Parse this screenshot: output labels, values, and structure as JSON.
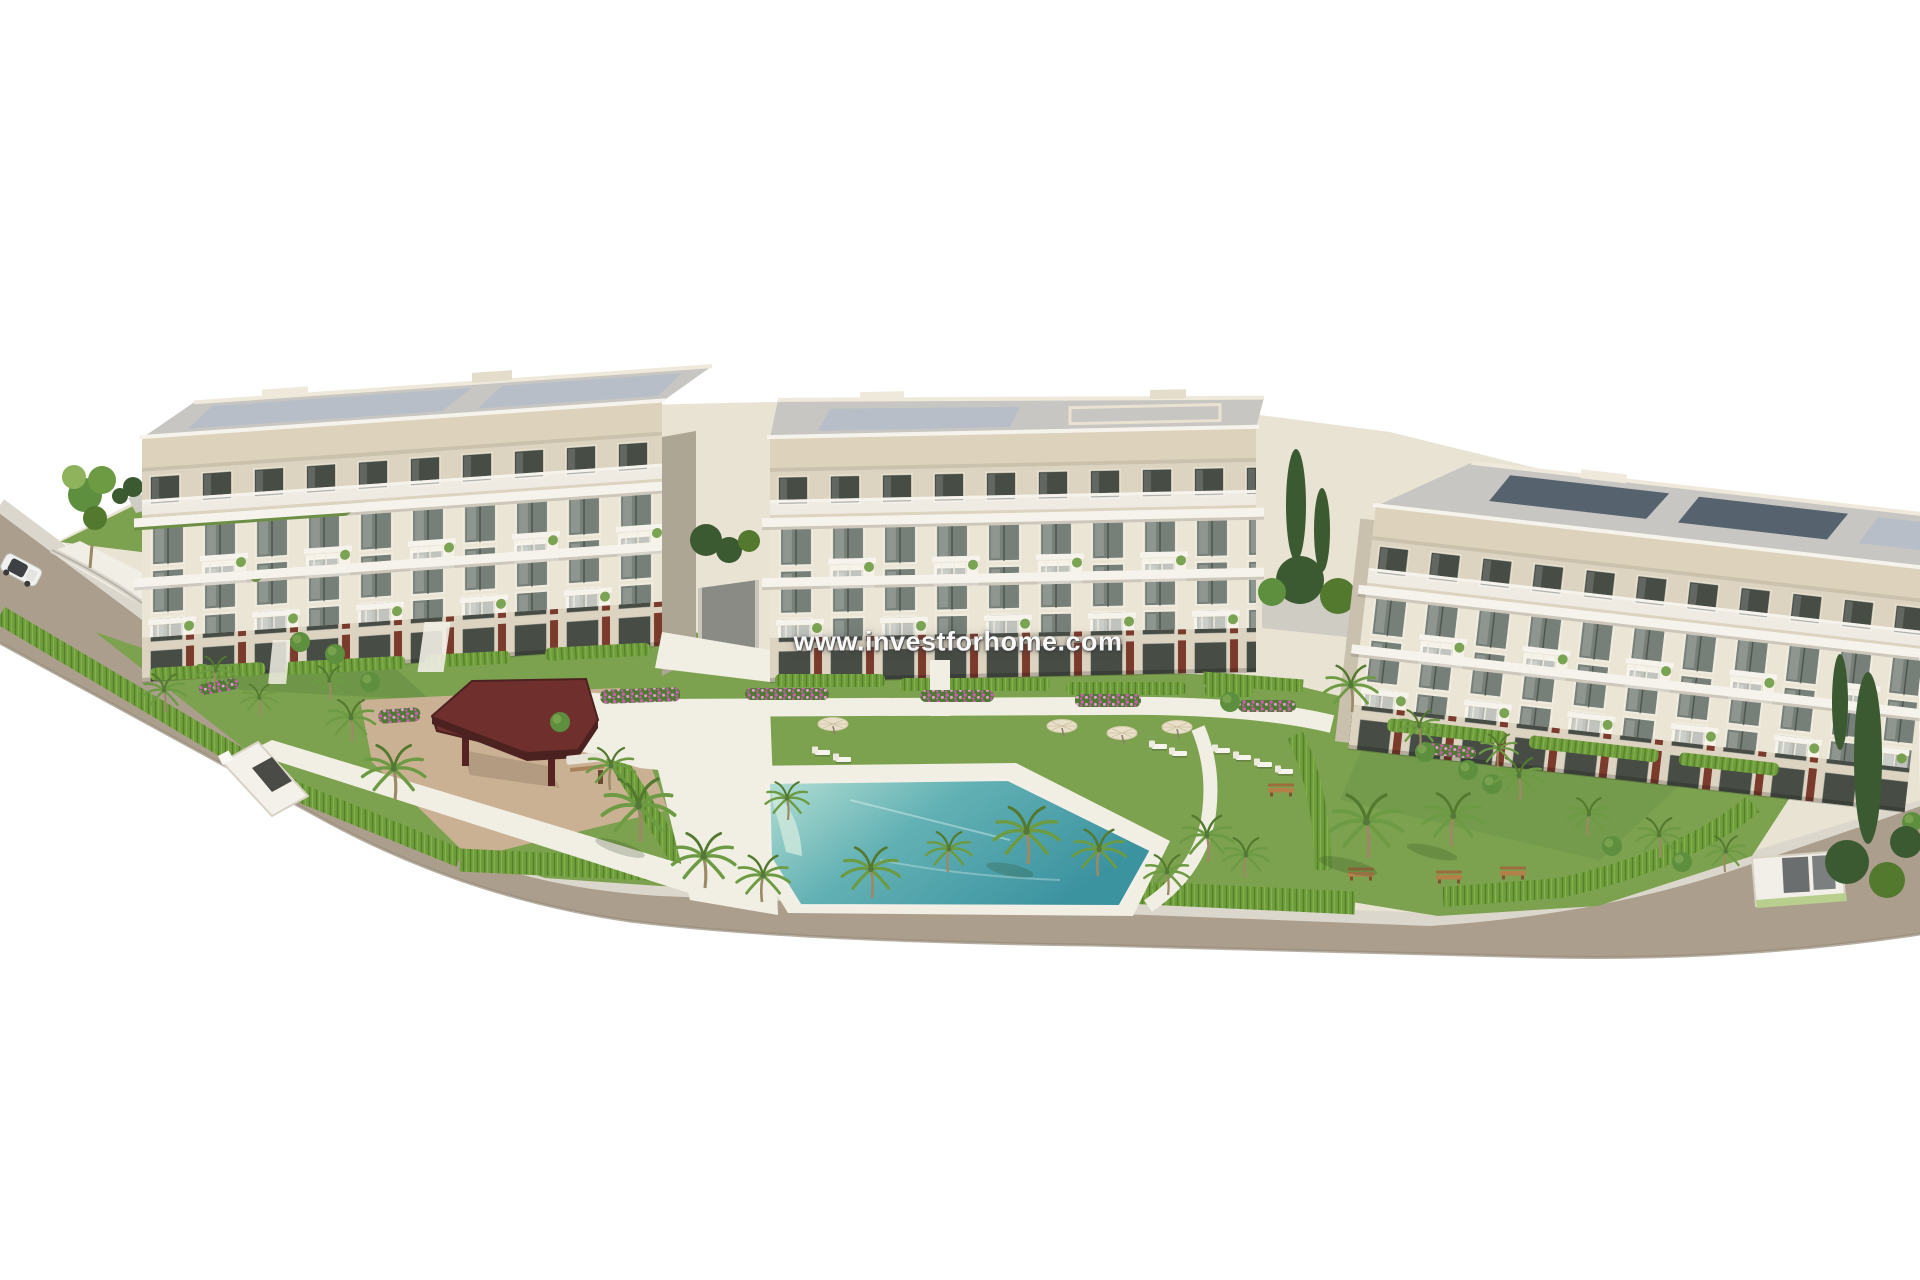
{
  "watermark": {
    "text": "www.investforhome.com"
  },
  "scene": {
    "type": "3D architectural rendering",
    "subject": "Residential apartment complex of three low-rise blocks with landscaped communal gardens",
    "buildings": [
      {
        "label": "left apartment block",
        "floors": 4
      },
      {
        "label": "middle apartment block",
        "floors": 4
      },
      {
        "label": "right apartment block",
        "floors": 4
      }
    ],
    "features": [
      "communal swimming pool",
      "white pool deck with sun loungers",
      "cream parasols",
      "dark-red wooden gazebo with picnic table",
      "palm trees",
      "bright hedge fencing around the plot",
      "flower beds",
      "garden paths",
      "wooden benches",
      "perimeter road with pavement kerb",
      "parked white car",
      "entrance gate structures",
      "rooftop solar panels"
    ]
  },
  "colors": {
    "bg": "#ffffff",
    "road": "#ab9e8d",
    "roadEdge": "#978b7a",
    "curb": "#dcd7cc",
    "paving": "#e9e3d4",
    "deck": "#f1eee4",
    "sand": "#cbb193",
    "grass": "#7da24f",
    "grassDark": "#5e8440",
    "grassLight": "#8fb25c",
    "hedge": "#6f9d3c",
    "hedgeDark": "#537f2b",
    "hedgeLight": "#83b14c",
    "pool1": "#b4dfd4",
    "pool2": "#62b1b4",
    "pool3": "#3c93a0",
    "facade": "#ebe5d6",
    "facadeShade": "#dcd3c0",
    "fascia": "#ddd3bd",
    "slab": "#f6f3ec",
    "roofA": "#c7c6c2",
    "roofB": "#b7bec8",
    "solar": "#57626f",
    "glass": "#767f78",
    "glassDark": "#474d45",
    "accent": "#7a3a2c",
    "sideWall": "#aea694",
    "gazeboRoof": "#6e2f2d",
    "gazeboDark": "#552422",
    "trunk": "#9b8a66",
    "frond": "#6d9b43",
    "frondDark": "#53792f",
    "bush": "#5d8f3f",
    "cypress": "#3c5a31",
    "flowerBase": "#4e7a33",
    "flowerA": "#cb5fae",
    "flowerB": "#e59ed0",
    "bench": "#b3804a",
    "umbrella": "#e9e0ca",
    "wall": "#cfccc4",
    "carGlass": "#3d4144"
  }
}
